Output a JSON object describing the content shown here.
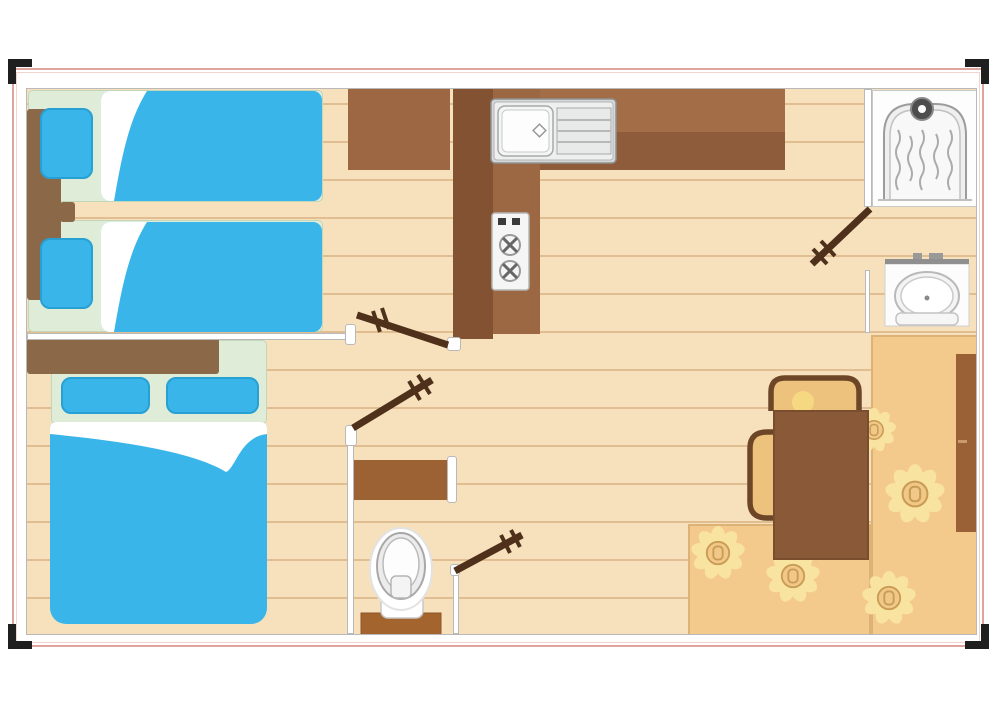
{
  "palette": {
    "floor_tan": "#f7e1bd",
    "plank_line": "rgba(205,163,112,0.55)",
    "wall_outline": "#b9b9b9",
    "plan_border_pink": "#dfa49e",
    "mark_black": "#1f1f1f",
    "bed_blue": "#39b5e9",
    "bed_blue_border": "#27a0d4",
    "bed_base_green": "#dfecd8",
    "bed_base_border": "#c2d6ba",
    "headboard_brown": "#8b6847",
    "counter_light": "#a26d47",
    "counter_dark": "#8e5c3a",
    "column_dark": "#835233",
    "column_light": "#9c6743",
    "wardrobe_b1_brown": "#9c6742",
    "table_brown": "#8a5a38",
    "table_border": "#7a4d2e",
    "chair_outline": "#6d4628",
    "chair_seat": "#edc27c",
    "door_brown": "#4e301b",
    "orange_floor": "#f3c98c",
    "orange_border": "#ddb277",
    "sunflower_petal": "#f8e3a0",
    "sunflower_center": "#f1c887",
    "sunflower_ring": "#c99c56",
    "wardrobe_right_brown": "#9a6136",
    "tank_brown": "#a4642e",
    "shelf_brown": "#9c6234",
    "metal_gray": "#d5d8d9",
    "fixture_outline": "#a8a8a8"
  },
  "plan": {
    "type": "floor-plan",
    "doors_count": 4,
    "rooms": [
      {
        "name": "bedroom-twin",
        "furniture": [
          "single-bed",
          "single-bed",
          "headboard",
          "wardrobe"
        ]
      },
      {
        "name": "bedroom-double",
        "furniture": [
          "double-bed",
          "headboard"
        ]
      },
      {
        "name": "kitchen",
        "furniture": [
          "counter",
          "sink-drainer-unit",
          "stove-two-burners"
        ]
      },
      {
        "name": "bathroom",
        "furniture": [
          "shower-cubicle",
          "washbasin"
        ]
      },
      {
        "name": "wc",
        "furniture": [
          "toilet",
          "shelf"
        ]
      },
      {
        "name": "living-dining",
        "furniture": [
          "dining-table",
          "chair",
          "chair",
          "tall-cabinet",
          "sunflower-rug"
        ]
      }
    ]
  }
}
